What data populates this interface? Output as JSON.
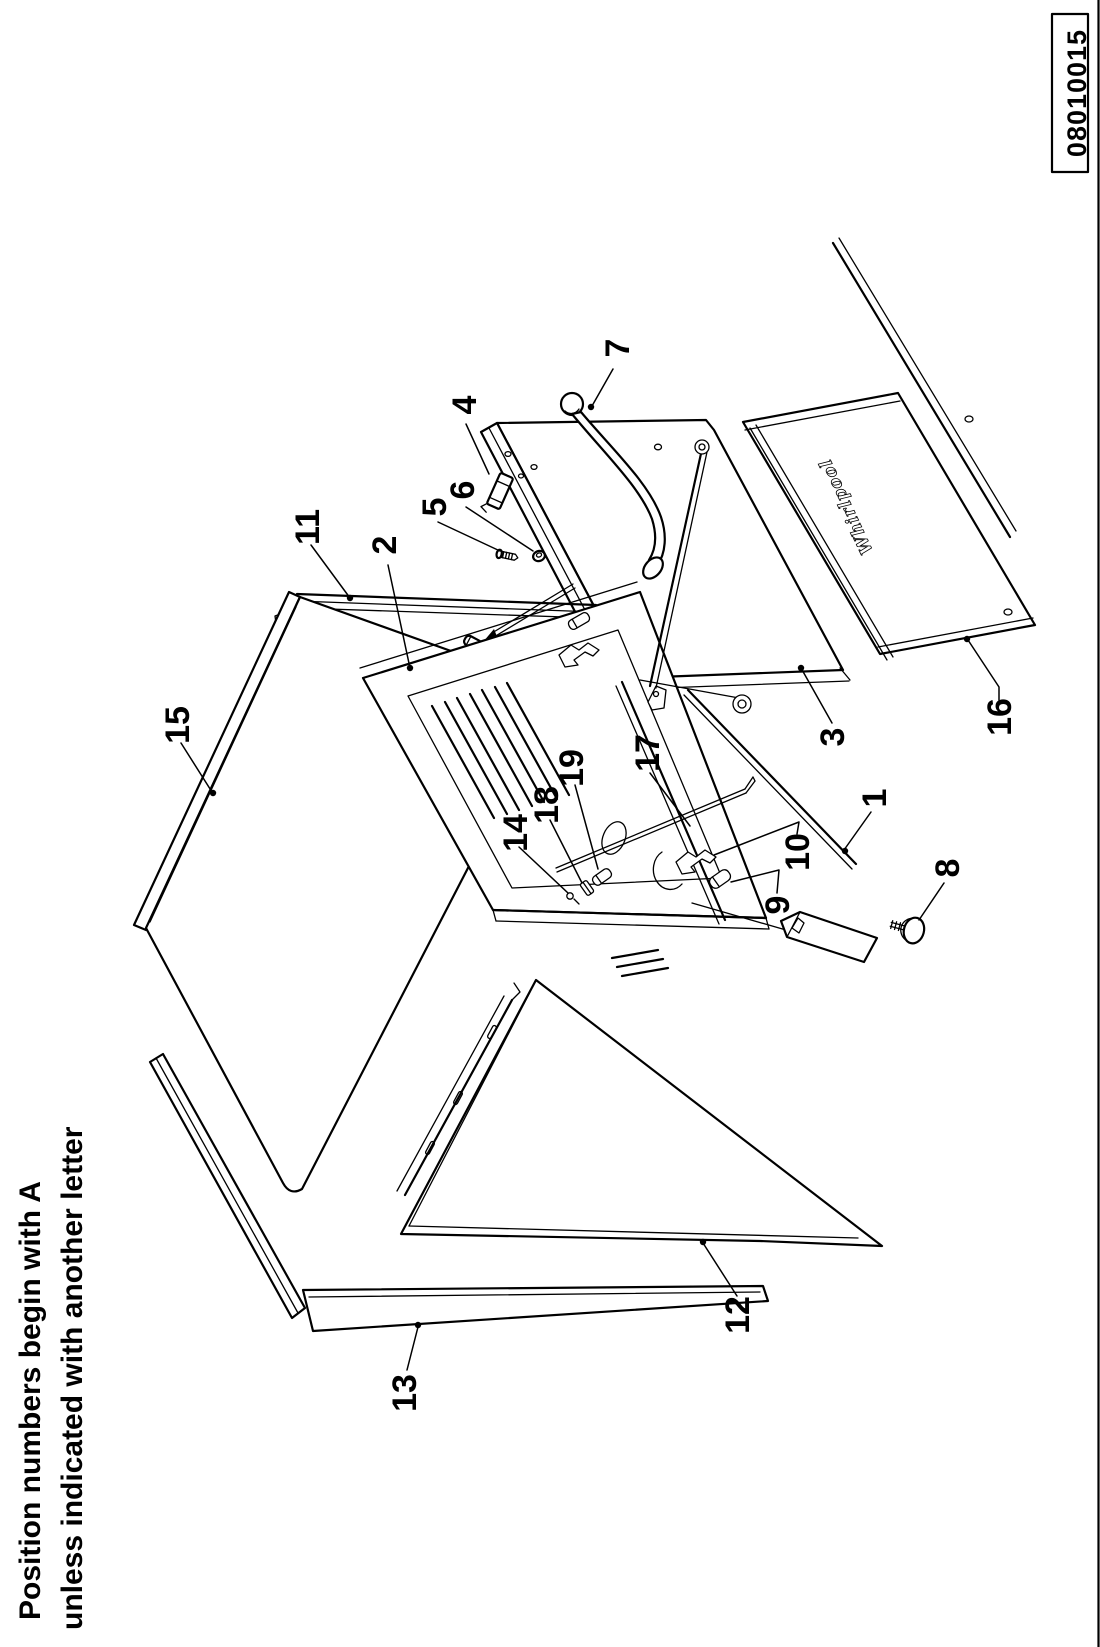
{
  "page": {
    "margin_note": {
      "line1": "Position numbers begin with A",
      "line2": "unless indicated with another letter"
    },
    "part_number": "08010015"
  },
  "diagram": {
    "brand_logo": "Whirlpool",
    "callouts": [
      {
        "label": "1"
      },
      {
        "label": "2"
      },
      {
        "label": "3"
      },
      {
        "label": "4"
      },
      {
        "label": "5"
      },
      {
        "label": "6"
      },
      {
        "label": "7"
      },
      {
        "label": "8"
      },
      {
        "label": "9"
      },
      {
        "label": "10"
      },
      {
        "label": "11"
      },
      {
        "label": "12"
      },
      {
        "label": "13"
      },
      {
        "label": "14"
      },
      {
        "label": "15"
      },
      {
        "label": "16"
      },
      {
        "label": "17"
      },
      {
        "label": "18"
      },
      {
        "label": "19"
      }
    ]
  }
}
